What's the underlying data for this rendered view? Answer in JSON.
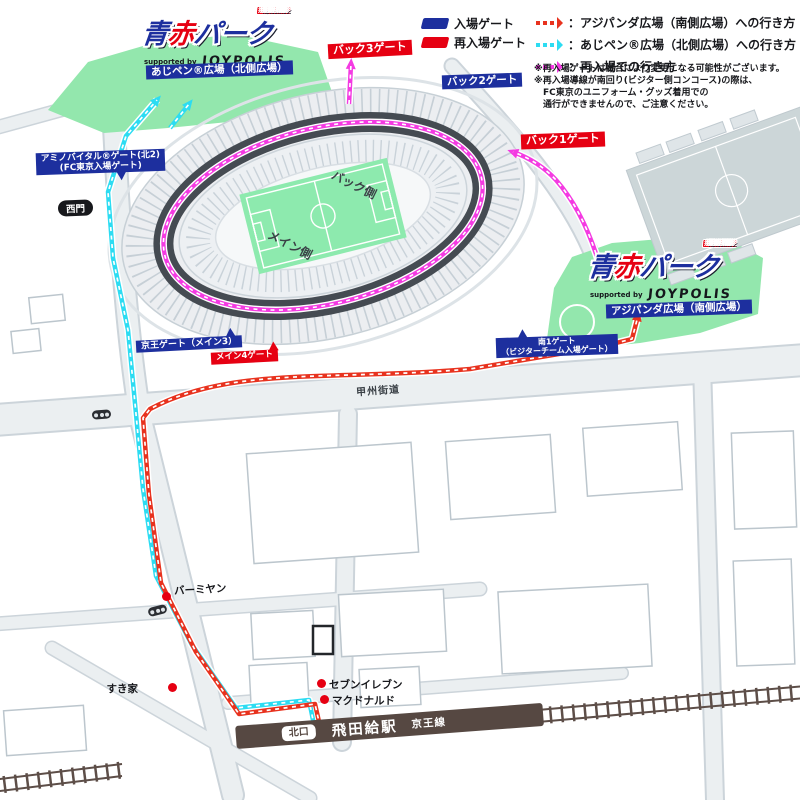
{
  "colors": {
    "entry_blue": "#1d2f9e",
    "reentry_red": "#e60012",
    "route_red": "#e8321e",
    "route_cyan": "#2cdcf2",
    "route_magenta": "#f43ae2",
    "plaza_green": "#93e7ad",
    "pitch_green": "#8deaae",
    "station_brown": "#564842"
  },
  "brand": {
    "ao": "青",
    "aka": "赤",
    "park": "パーク",
    "badge": "AO-AKA PARK",
    "supported_by": "supported by",
    "sponsor": "JOYPOLIS"
  },
  "legend": {
    "entry_gate_label": "入場ゲート",
    "reentry_gate_label": "再入場ゲート",
    "route_items": [
      {
        "label": "：アジパンダ広場（南側広場）への行き方"
      },
      {
        "label": "：あじペン®広場（北側広場）への行き方"
      },
      {
        "label": "：再入場での行き方"
      }
    ],
    "notes": [
      "※再入場ゲートは試合により変更になる可能性がございます。",
      "※再入場導線が南回り(ビジター側コンコース)の際は、",
      "　FC東京のユニフォーム・グッズ着用での",
      "　通行ができませんので、ご注意ください。"
    ]
  },
  "plazas": {
    "north": "あじペン®広場（北側広場）",
    "south": "アジパンダ広場（南側広場）"
  },
  "gates": {
    "back3": "バック3ゲート",
    "back2": "バック2ゲート",
    "back1": "バック1ゲート",
    "amino_line1": "アミノバイタル®ゲート(北2)",
    "amino_line2": "(FC東京入場ゲート)",
    "west": "西門",
    "keio": "京王ゲート（メイン3）",
    "main4": "メイン4ゲート",
    "south1_line1": "南1ゲート",
    "south1_line2": "（ビジターチーム入場ゲート）"
  },
  "stadium": {
    "back_side": "バック側",
    "main_side": "メイン側"
  },
  "road": {
    "koshu": "甲州街道"
  },
  "pois": [
    {
      "name": "バーミヤン"
    },
    {
      "name": "すき家"
    },
    {
      "name": "セブンイレブン"
    },
    {
      "name": "マクドナルド"
    }
  ],
  "station": {
    "exit": "北口",
    "name": "飛田給駅",
    "line": "京王線"
  }
}
